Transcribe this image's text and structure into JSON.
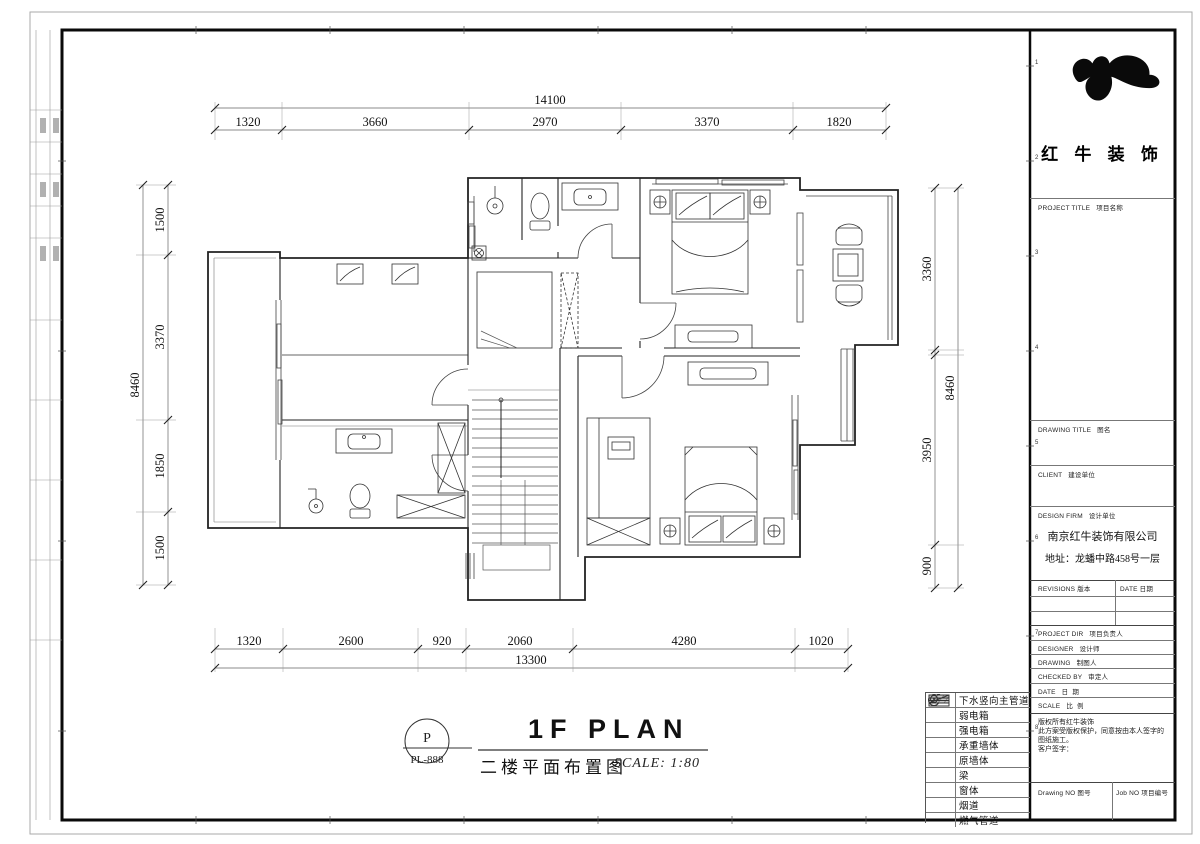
{
  "frame": {
    "grid_numbers": [
      "1",
      "2",
      "3",
      "4",
      "5",
      "6",
      "7",
      "8"
    ]
  },
  "logo": {
    "company": "红 牛 装 饰"
  },
  "title_block": {
    "project_title": "PROJECT TITLE   项目名称",
    "drawing_title": "DRAWING TITLE   图名",
    "client": "CLIENT   建设单位",
    "design_firm": "DESIGN FIRM   设计单位",
    "firm_name": "南京红牛装饰有限公司",
    "firm_address": "地址：龙蟠中路458号一层",
    "revisions": "REVISIONS 版本",
    "date_col": "DATE 日期",
    "rows": [
      "PROJECT DIR   项目负责人",
      "DESIGNER   设计师",
      "DRAWING   制图人",
      "CHECKED BY   审定人",
      "DATE   日  期",
      "SCALE   比  例"
    ],
    "copyright_line1": "版权所有红牛装饰",
    "copyright_line2": "此方案受版权保护，同意按由本人签字的图纸施工。",
    "client_sign": "客户签字：",
    "drawing_no": "Drawing NO 图号",
    "job_no": "Job NO 项目编号"
  },
  "titlebar": {
    "stamp_letter": "P",
    "stamp_code": "PL-888",
    "title_en": "1F PLAN",
    "title_cn": "二楼平面布置图",
    "scale": "SCALE: 1:80"
  },
  "legend": {
    "items": [
      {
        "label": "下水竖向主管道"
      },
      {
        "letter": "R",
        "label": "弱电箱"
      },
      {
        "letter": "P",
        "label": "强电箱"
      },
      {
        "label": "承重墙体"
      },
      {
        "label": "原墙体"
      },
      {
        "label": "梁"
      },
      {
        "label": "窗体"
      },
      {
        "label": "烟道"
      },
      {
        "label": "燃气管道"
      }
    ]
  },
  "dimensions": {
    "top_total": "14100",
    "top": [
      "1320",
      "3660",
      "2970",
      "3370",
      "1820"
    ],
    "bottom": [
      "1320",
      "2600",
      "920",
      "2060",
      "4280",
      "1020"
    ],
    "bottom_total": "13300",
    "left_total": "8460",
    "left": [
      "1500",
      "3370",
      "1850",
      "1500"
    ],
    "right": [
      "3360",
      "3950",
      "900"
    ],
    "right_total": "8460"
  }
}
